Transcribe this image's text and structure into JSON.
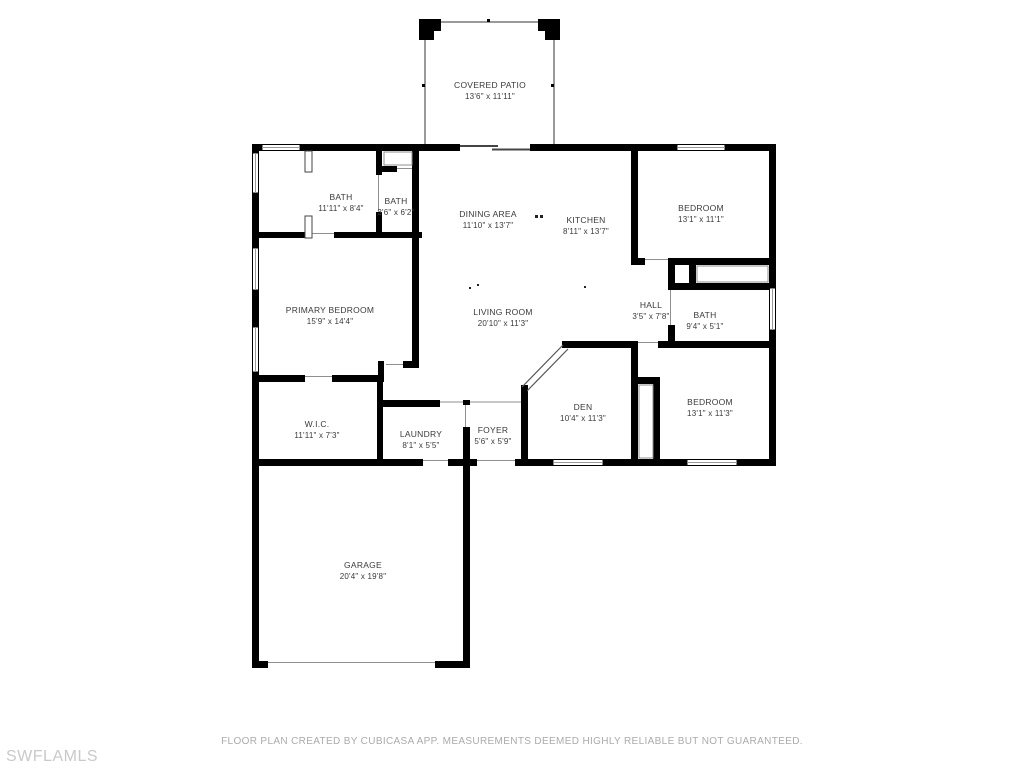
{
  "floor_plan": {
    "rooms": [
      {
        "id": "covered_patio",
        "name": "COVERED PATIO",
        "dims": "13'6\" x 11'11\""
      },
      {
        "id": "bath_main",
        "name": "BATH",
        "dims": "11'11\" x 8'4\""
      },
      {
        "id": "bath_small",
        "name": "BATH",
        "dims": "3'6\" x 6'2\""
      },
      {
        "id": "dining_area",
        "name": "DINING AREA",
        "dims": "11'10\" x 13'7\""
      },
      {
        "id": "kitchen",
        "name": "KITCHEN",
        "dims": "8'11\" x 13'7\""
      },
      {
        "id": "bedroom_ne",
        "name": "BEDROOM",
        "dims": "13'1\" x 11'1\""
      },
      {
        "id": "primary_bedroom",
        "name": "PRIMARY BEDROOM",
        "dims": "15'9\" x 14'4\""
      },
      {
        "id": "living_room",
        "name": "LIVING ROOM",
        "dims": "20'10\" x 11'3\""
      },
      {
        "id": "hall",
        "name": "HALL",
        "dims": "3'5\" x 7'8\""
      },
      {
        "id": "bath_hall",
        "name": "BATH",
        "dims": "9'4\" x 5'1\""
      },
      {
        "id": "wic",
        "name": "W.I.C.",
        "dims": "11'11\" x 7'3\""
      },
      {
        "id": "laundry",
        "name": "LAUNDRY",
        "dims": "8'1\" x 5'5\""
      },
      {
        "id": "foyer",
        "name": "FOYER",
        "dims": "5'6\" x 5'9\""
      },
      {
        "id": "den",
        "name": "DEN",
        "dims": "10'4\" x 11'3\""
      },
      {
        "id": "bedroom_se",
        "name": "BEDROOM",
        "dims": "13'1\" x 11'3\""
      },
      {
        "id": "garage",
        "name": "GARAGE",
        "dims": "20'4\" x 19'8\""
      }
    ],
    "footer": "FLOOR PLAN CREATED BY CUBICASA APP. MEASUREMENTS DEEMED HIGHLY RELIABLE BUT NOT GUARANTEED.",
    "watermark": "SWFLAMLS",
    "colors": {
      "wall": "#000000",
      "label": "#3a3a3a",
      "footer": "#ababab",
      "watermark": "#c9c9c9",
      "background": "#ffffff"
    }
  }
}
